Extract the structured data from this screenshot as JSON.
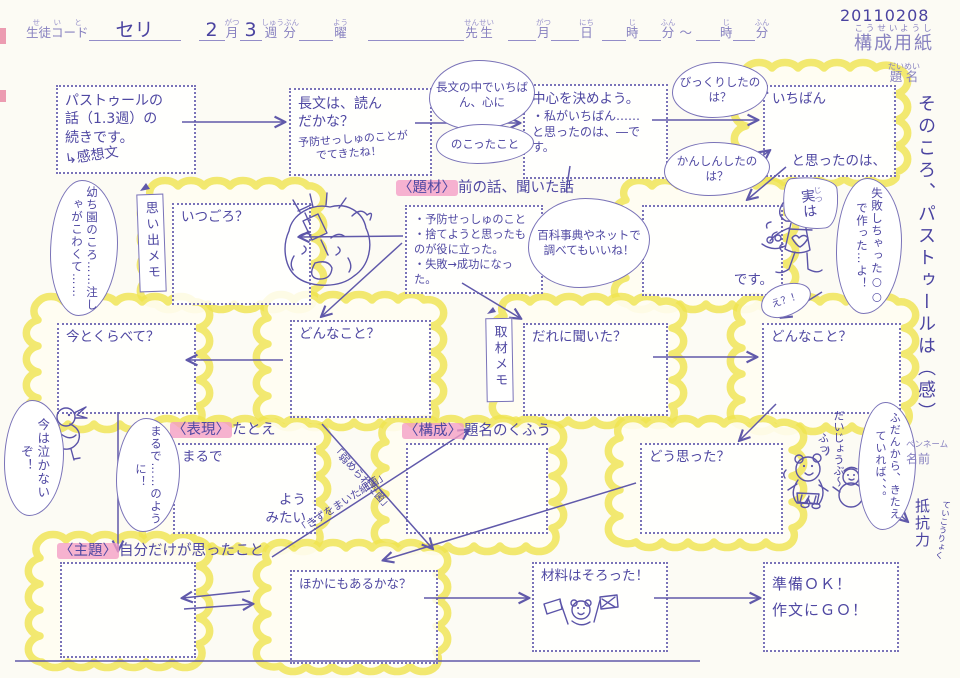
{
  "header": {
    "student_code": {
      "label": "生徒コード",
      "furigana": "せいと",
      "value": "セリ"
    },
    "month": {
      "label": "月",
      "furigana": "がつ",
      "value": "2"
    },
    "week": {
      "label": "週分",
      "furigana": "しゅうぶん",
      "value": "3"
    },
    "weekday": {
      "label": "曜",
      "furigana": "よう"
    },
    "teacher": {
      "label": "先生",
      "furigana": "せんせい"
    },
    "time": {
      "month_label": "月",
      "month_furigana": "がつ",
      "day_label": "日",
      "day_furigana": "にち",
      "hour_label": "時",
      "hour_furigana": "じ",
      "minute_label": "分",
      "minute_furigana": "ふん",
      "tilde": "～",
      "hour2_label": "時",
      "hour2_furigana": "じ",
      "minute2_label": "分",
      "minute2_furigana": "ふん"
    },
    "written_date": "20110208",
    "sheet_title": {
      "label": "構成用紙",
      "furigana": "こうせいようし"
    }
  },
  "margin": {
    "title_label": {
      "label": "題名",
      "furigana": "だいめい"
    },
    "title_written": "そのころ、パストゥールは（感）",
    "penname_label": "ペンネーム",
    "name_label": "名前",
    "resistance": {
      "word": "抵抗力",
      "furigana": "ていこうりょく"
    }
  },
  "nodes": {
    "start": {
      "line1": "パストゥールの",
      "line2": "話（1.3週）の",
      "line3": "続きです。",
      "note": "↳感想文"
    },
    "read_check": {
      "line1": "長文は、読ん",
      "line2": "だかな？",
      "line3": "予防せっしゅのことが",
      "line4": "でてきたね！"
    },
    "center": {
      "line1": "中心を決めよう。",
      "line2": "・私がいちばん……",
      "line3": "と思ったのは、―です。"
    },
    "ichiban": {
      "prefix": "いちばん",
      "suffix": "と思ったのは、"
    },
    "when": {
      "label": "いつごろ？"
    },
    "memo_list": {
      "line1": "・予防せっしゅのこと",
      "line2": "・捨てようと思ったも",
      "line3": "のが役に立った。",
      "line4": "・失敗→成功になった。"
    },
    "desu": {
      "suffix": "です。"
    },
    "compare_now": {
      "label": "今とくらべて？"
    },
    "what_left": {
      "label": "どんなこと？"
    },
    "who_asked": {
      "label": "だれに聞いた？"
    },
    "what_right": {
      "label": "どんなこと？"
    },
    "simile": {
      "prefix": "まるで",
      "suffix1": "よう",
      "suffix2": "みたい"
    },
    "how_felt": {
      "label": "どう思った？"
    },
    "anything_else": {
      "label": "ほかにもあるかな？"
    },
    "materials": {
      "label": "材料はそろった！"
    },
    "ready": {
      "line1": "準備ＯＫ！",
      "line2": "作文にＧＯ！"
    }
  },
  "tags": {
    "daizai": {
      "tag": "〈題材〉",
      "text": "前の話、聞いた話"
    },
    "hyougen": {
      "tag": "〈表現〉",
      "text": "たとえ"
    },
    "kousei": {
      "tag": "〈構成〉",
      "text": "題名のくふう"
    },
    "shudai": {
      "tag": "〈主題〉",
      "text": "自分だけが思ったこと"
    }
  },
  "banners": {
    "omoide": "思い出メモ",
    "shuzai": "取材メモ"
  },
  "bubbles": {
    "nagabun_1": "長文の中でいちばん、心に",
    "nagabun_2": "のこったこと",
    "bikkuri": "びっくりしたのは？",
    "kanshin": "かんしんしたのは？",
    "hyakka": "百科事典やネットで調べてもいいね！",
    "jitsuwa": {
      "kanji": "実",
      "furigana": "じつ",
      "kana": "は"
    },
    "shippai": "失敗しちゃった○○で作った…よ！",
    "e_fox": "え？！",
    "youchien": "幼ち園のころ……注しゃがこわくて……",
    "nakanai": "今は泣かないぞ！",
    "marude": "まるで……のように！",
    "fudan": "ふだんから、きたえていれば、、。"
  },
  "free_text": {
    "daijoubu": "だいじょうぶ～",
    "fu": "ふっ"
  },
  "scribbles": {
    "diag1": "「弱められた菌」",
    "diag2": "「きずをまいた細菌」"
  },
  "doodles": {
    "face": "crying-face-with-syringe",
    "fox": "fox-character-speaking",
    "bird": "brave-chick",
    "bear_snowman": "bear-and-snowman",
    "flag_bear": "bear-with-flags"
  },
  "colors": {
    "ink": "#544da5",
    "cloud_yellow": "#efe34f",
    "highlight_pink": "#f49cc5",
    "paper": "#fcfbf4"
  }
}
